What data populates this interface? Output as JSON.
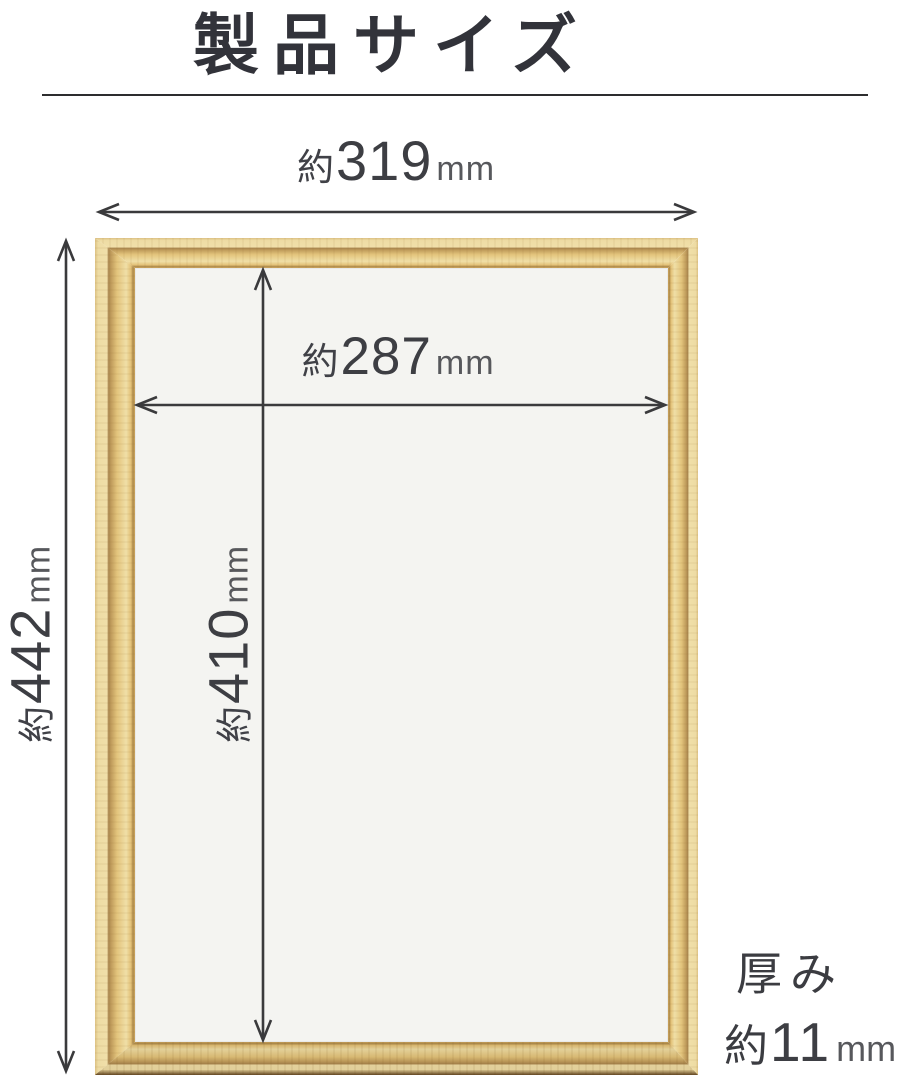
{
  "title": "製品サイズ",
  "dimensions": {
    "outer_width": {
      "approx": "約",
      "value": "319",
      "unit": "mm"
    },
    "inner_width": {
      "approx": "約",
      "value": "287",
      "unit": "mm"
    },
    "outer_height": {
      "approx": "約",
      "value": "442",
      "unit": "mm"
    },
    "inner_height": {
      "approx": "約",
      "value": "410",
      "unit": "mm"
    },
    "thickness": {
      "label": "厚み",
      "approx": "約",
      "value": "11",
      "unit": "mm"
    }
  },
  "colors": {
    "wood": "#e3c47c",
    "wood_groove": "#a9864e",
    "interior": "#f4f4f1",
    "dimension_line": "#3a3a3c",
    "text": "#3d3e43"
  }
}
